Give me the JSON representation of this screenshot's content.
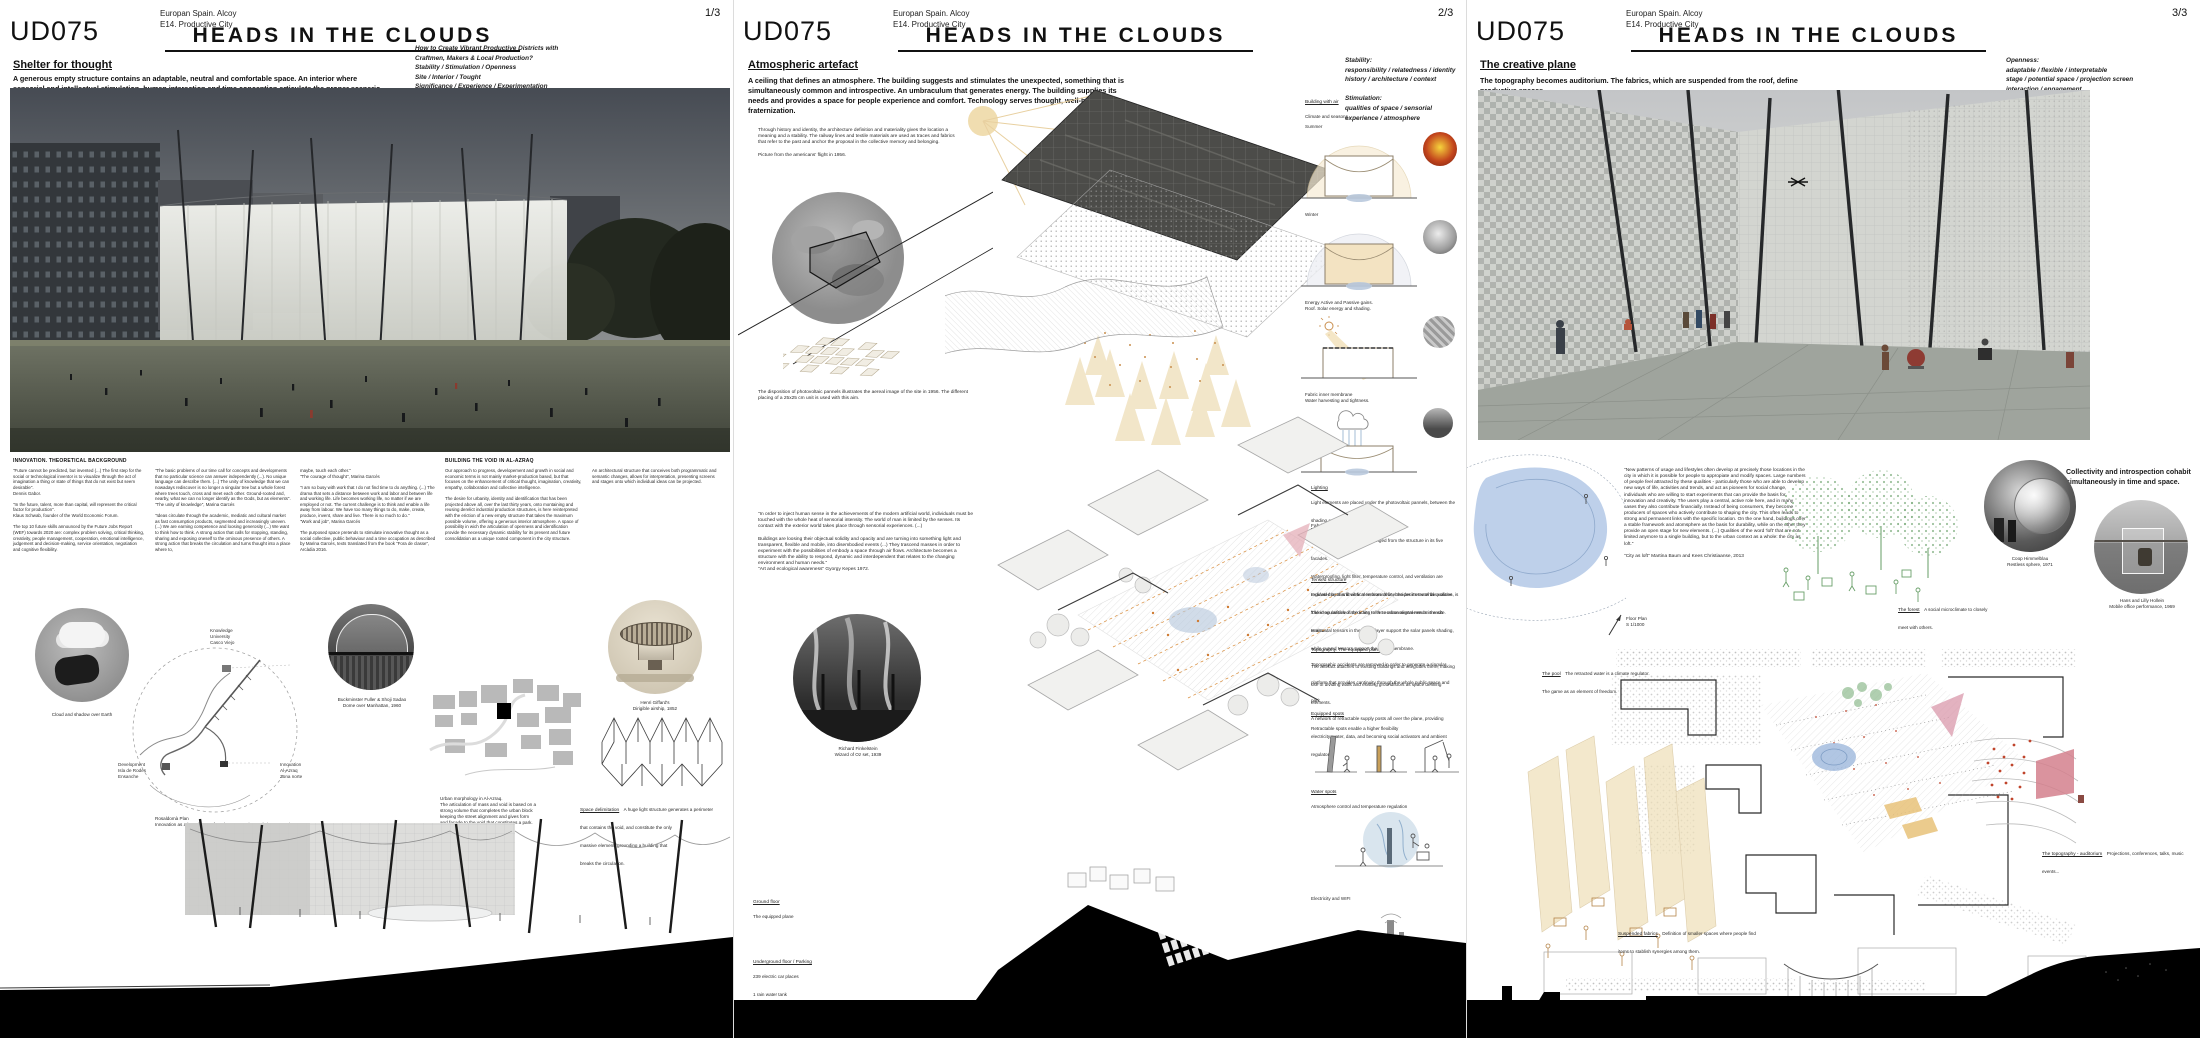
{
  "p1": {
    "meta": "Europan Spain. Alcoy\nE14. Productive City",
    "page": "1/3",
    "code": "UD075",
    "title": "HEADS IN THE CLOUDS",
    "subtitle": "Shelter for thought",
    "intro": "A generous empty structure contains an adaptable, neutral and comfortable space. An interior where sensorial and intellectual stimulation, human interaction and time conception articulate the proper scenario for thought and interchange, as bases for the innovative pulse. It is not a working space. It is not a building.\nIt is a screen, a common stage onto which individual ideas can be projected.",
    "brief": "How to Create Vibrant Productive Districts with\nCraftmen, Makers & Local Production?\nStability / Stimulation / Openness\nSite / Interior / Tought\nSignificance / Experience / Experimentation",
    "col1_head": "INNOVATION. THEORETICAL BACKGROUND",
    "col1": "\"Future cannot be predicted, but invented (...) The first step for the social or technological inventor is to visualize through the act of imagination a thing or state of things that do not exist but seem desirable\".\nDennis Gabor.\n\n\"In the future, talent, more than capital, will represent the critical factor for production\".\nKlaus Schwab, founder of the World Economic Forum.\n\nThe top 10 future skills announced by the Future Jobs Report (WEF) towards 2020 are: complex problem solving, critical thinking, creativity, people management, cooperation, emotional intelligence, judgement and decision-making, service orientation, negotiation and cognitive flexibility.",
    "col2": "\"The basic problems of our time call for concepts and developments that no particular science can answer independently (...). No unique language can describe them. (...) The unity of knowledge that we can nowadays rediscover is no longer a singular tree but a whole forest where trees touch, cross and meet each other. Ground-rooted and, nearby, what we can no longer identify as the Gods, but as elements\".\n\"The unity of knowledge\", Marina Garcés\n\n\"Ideas circulate through the academic, mediatic and cultural market as fast consumption products, segmented and increasingly uneven. (...) We are earning competence and loosing generosity (...) We want to think how to think. A strong action that calls for stopping, standing, sharing and exposing oneself to the ominous presence of others. A strong action that breaks the circulation and turns thought into a place where to,",
    "col3": "maybe, touch each other.\"\n\"The courage of thought\", Marina Garcés\n\n\"I am so busy with work that I do not find time to do anything. (...) The drama that sets a distance between work and labor and between life and working life. Life becomes working life, no matter if we are employed or not. The current challenge is to think and enable a life away from labour. We have too many things to do, make, create, produce, invent, share and live. There is so much to do.\"\n\"Work and job\", Marina Garcés\n\nThe purposed space pretends to stimulate innovative thought as a social collective, public behaviour and a time occupation as described by Marina Garcés, texts translated from the book \"Fora de classe\", Arcàdia 2016.",
    "col4_head": "BUILDING THE VOID IN AL-AZRAQ",
    "col4": "Our approach to progress, developement and growth in social and economic terms is not mainly market-production based, but that focuses on the enhancement of critical thought, imagination, creativity, empathy, collaboration and collective intelligence.\n\nThe desire for urbanity, identity and identification that has been projected above all, over the last thirty years, onto montaining and reusing derelict industrial production structures, is here reinterpreted with the eriction of a new empty structure that takes the maximum possible volume, offering a generous interior atmosphere. A space of possibility in wich the articulation of openness and identification provide the necessary dynamic stability for its present and future consolidation as a unique rooted component in the city structure.",
    "col5": "An architectural structure that conceives both programmatic and semantic changes, allows for interpretation, presenting screens and stages onto which individual ideas can be projected.",
    "cap_cloud": "Cloud and shadow over Earth",
    "map_label_knowledge": "Knowledge\nUniversity\nCasco Viejo",
    "map_label_development": "Development\nIsla de Rodes\nEnsanche",
    "map_label_innovation": "Innovation\nAl-Azraq\nZona norte",
    "cap_plan": "Rosaldomà Plan\nInnovation as a key element for urban structuring and city connection.",
    "cap_dome": "Buckminster Fuller & Shoji Sadao\nDome over Manhattan, 1960",
    "cap_morphology": "Urban morphology in Al-Azraq.\nThe articulation of mass and void is based on a\nstrong volume that completes the urban block\nkeeping the street alignment and gives form\nand facade to the void that constitutes a park.",
    "cap_dirigible": "Henri Giffard's\nDirigible airship, 1852",
    "sd_head": "Space delimitation",
    "sd_body": "A huge light structure generates a perimeter\nthat contains the void, and constitute the only\nmassive element, grounding a building that\nbreaks the circulation.",
    "footer": "Interior section\nS: 1/200"
  },
  "p2": {
    "meta": "Europan Spain. Alcoy\nE14. Productive City",
    "page": "2/3",
    "code": "UD075",
    "title": "HEADS IN THE CLOUDS",
    "subtitle": "Atmospheric artefact",
    "intro": "A ceiling that defines an atmosphere. The building suggests and stimulates the unexpected, something that is simultaneously common and introspective. An umbraculum that generates energy. The building supplies its needs and provides a space for people experience and comfort. Technology serves thought, well-being and fraternization.",
    "brief": "Stability:\nresponsibility / relatedness / identity\nhistory / architecture / context\n\nStimulation:\nqualities of space / sensorial\nexperience / atmosphere",
    "history": "Through history and identity, the architecture definition and materiality gives the location a meaning and a stability. The railway lines and textile materials are used as traces and fabrics that refer to the past and  anchor the proposal in the collective memory and belonging.\n\nPicture from the americans' flight in 1956.",
    "pv_caption": "The disposition of photovoltaic pannels illustrates the aereal image of the site in 1956. The different placing of a 25x25 cm unit is used with this aim.",
    "kepes": "\"In order to inject human sense in the achievements of the modern artificial world, individuals must be touched with the whole heat of sensorial intensity. The world of man is limited by the senses. Its contact with the exterior world takes place through sensorial experiences. (...)\n\nBuildings are loosing their objectual solidity and opacity and are turning into something light and transparent, flexible and mobile, into disembodied events (...) They trascend masses in order to experiment with the possibilities of embody a space through air flows. Architecture becomes a structure with the ability to respond, dynamic and interdependent that relates to the changing environment and human needs.\"\n\"Art and ecological awareness\" Gyorgy Kepes 1972.",
    "cap_oz": "Richard Finkelstein\nWizard of Oz set, 1939",
    "bw_head": "Building with air",
    "bw_sub": "Climate and seasons",
    "summer": "Summer",
    "winter": "Winter",
    "energy": "Energy Active and Passive gains.\nRoof. Solar energy and shading.",
    "membrane": "Fabric inner membrane\nWater harvesting and tightness.",
    "light_head": "Lighting",
    "light_body": "Light elements are placed under the photovoltaic pannels, between the shading and the waterproof fabric layer.",
    "shelter_head": "Fabric shelter",
    "shelter_body": "A textile double membrane is hanged from the structure in its five facades.\nWaterproofing, light filter, temperature control, and ventilation are regulated by this flexible membrane that, besides its material qualities, is folded an unfolded according to the environmental needs in each season.",
    "tensed_head": "Tensed structure",
    "tensed_body": "Inclined masts and vertical tensors define the perimeter of the volume. The irregularities of the limits refer to urban alignments on the site.\nHorizontal tensors in the upper layer support the solar panels shading, while curved tensors support the fabric membrane.\nThe artefact attaches to existing buildings and integrates them, making use of dividing walls and existing groundfloors as space defining elements.",
    "topo_head": "Topography. The equipped plane",
    "topo_body": "Topographic accidents are removed in order to generate a singular platform that provides continuity through the whole public space and park.\nA network of retractable supply posts all over the plane, providing electricity, water, data, and becoming social activators and ambient regulators.",
    "equipped_head": "Equipped spots",
    "equipped_body": "Retractable spots enable a higher flexibility",
    "water_head": "Water spots",
    "water_body": "Atmosphere control and temperature regulation",
    "elec_head": "Electricity and WIFI",
    "gf_head": "Ground floor",
    "gf_body": "The equipped plane",
    "uf_head": "Underground floor / Parking",
    "uf_body": "239 electric car places\n1 rain water tank",
    "north": "N",
    "footer": "Axonometry S: 1/1000"
  },
  "p3": {
    "meta": "Europan Spain. Alcoy\nE14. Productive City",
    "page": "3/3",
    "code": "UD075",
    "title": "HEADS IN THE CLOUDS",
    "subtitle": "The creative plane",
    "intro": "The topography becomes auditorium. The fabrics, which are suspended from the roof, define productive spaces.\nThe forest delimitates a confortable microclimate. The water determine the atmosphere. The equipped spots supply\nthe  building with water, electricity and WIFI. The mobile furniture guarantees the total flexibility of space.",
    "brief": "Openness:\nadaptable / flexible / interpretable\nstage / potential space / projection screen\ninteraction / engagement",
    "quote": "\"New patterns of usage and lifestyles often develop at precisely those locations in the city in which it is possible for people to appropiate and modify spaces. Large numbers of people feel attracted by these qualities - particularly those who are able to develop new ways of life, activities and trends, and act as pioneers for social change, individuals who are willing to start experiments that can provide the basis for innovation and creativity. The users play a central, active role here, and in many cases they also contribute financially. Instead of being consumers, they become producers of spaces who actively contribute to shaping the city. This often leads to strong and permanent links with the specific location. On the one hand, buildings offer a stable framework and atomsphere as the basis for durability, while on the other they provide an open stage for new elements. (...) Qualities of the word 'loft' that are not limited anymore to a single building, but to the urban context as a whole: the city as loft.\"\n\n\"City as loft\" Martina Baum and Kees Christiaanse, 2013",
    "collectivity": "Collectivity and introspection cohabit\nsimultaneously in time and space.",
    "cap_coop": "Coop Himmelblau\nRestless sphere, 1971",
    "cap_hollein": "Hans and Lilly Hollein\nMobile office performance, 1969",
    "f_head": "The forest",
    "f_body": "A social microclimate to closely\nmeet with others.",
    "pool_head": "The pool",
    "pool_body": "The retracted water is a climate regulator.\nThe game as an element of freedom.",
    "plan_label": "Floor Plan\nS 1/1000",
    "north": "N",
    "aud_head": "The topography - auditorium",
    "aud_body": "Projections, conferences, talks, music events...",
    "fab_head": "Suspended fabrics",
    "fab_body": "Definition of smaller spaces where people find\nitems to stablish synergies among them.",
    "footer": "Section\nS: 1/1000"
  }
}
